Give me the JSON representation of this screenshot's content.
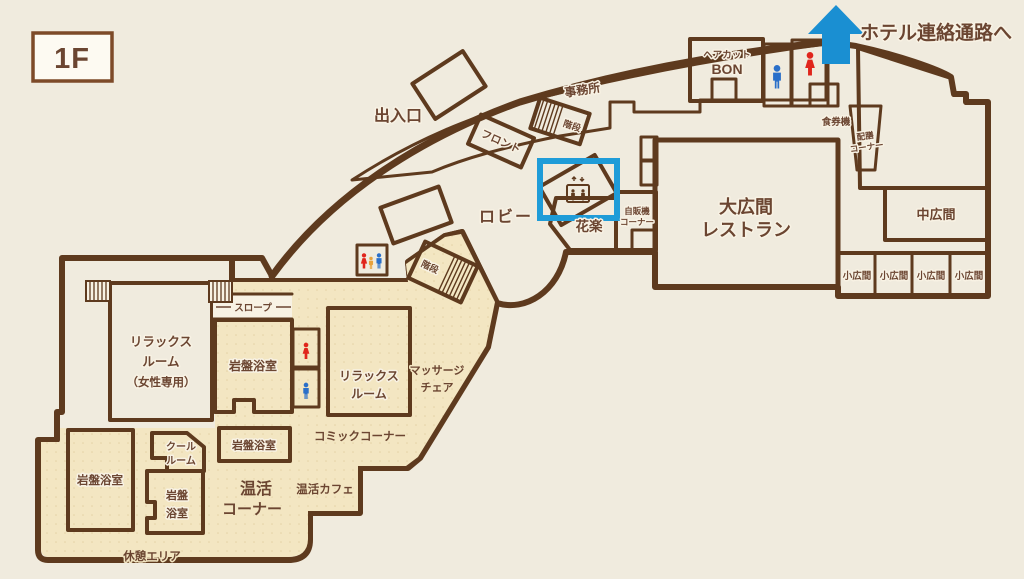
{
  "floor": {
    "badge": "1F"
  },
  "annotations": {
    "hotel_link": "ホテル連絡通路へ",
    "entrance": "出入口"
  },
  "upper": {
    "office": "事務所",
    "front_desk": "フロント",
    "stairs": "階段",
    "haircut_line1": "ヘアカット",
    "haircut_line2": "BON",
    "ticket_machine": "食券機",
    "serving_line1": "配膳",
    "serving_line2": "コーナー"
  },
  "lobby": {
    "label": "ロビー",
    "stairs": "階段",
    "flower_shop": "花楽",
    "vending_line1": "自販機",
    "vending_line2": "コーナー"
  },
  "halls": {
    "large_line1": "大広間",
    "large_line2": "レストラン",
    "medium": "中広間",
    "small": [
      "小広間",
      "小広間",
      "小広間",
      "小広間"
    ]
  },
  "wing": {
    "relax_women_line1": "リラックス",
    "relax_women_line2": "ルーム",
    "relax_women_line3": "（女性専用）",
    "slope": "スロープ",
    "stone_bath_a": "岩盤浴室",
    "stone_bath_b": "岩盤浴室",
    "stone_bath_c_line1": "岩盤",
    "stone_bath_c_line2": "浴室",
    "stone_bath_d": "岩盤浴室",
    "relax_line1": "リラックス",
    "relax_line2": "ルーム",
    "massage_line1": "マッサージ",
    "massage_line2": "チェア",
    "comic": "コミックコーナー",
    "cool_line1": "クール",
    "cool_line2": "ルーム",
    "onkatsu_line1": "温活",
    "onkatsu_line2": "コーナー",
    "cafe": "温活カフェ",
    "rest_area": "休憩エリア"
  },
  "colors": {
    "wall": "#5e3a1e",
    "highlight_blue": "#1f9cd8",
    "link_blue": "#1a8fd2",
    "entrance_red": "#d81e12",
    "toilet_male": "#2a6fc9",
    "toilet_female": "#e0251c",
    "toilet_child": "#e8a23c"
  }
}
